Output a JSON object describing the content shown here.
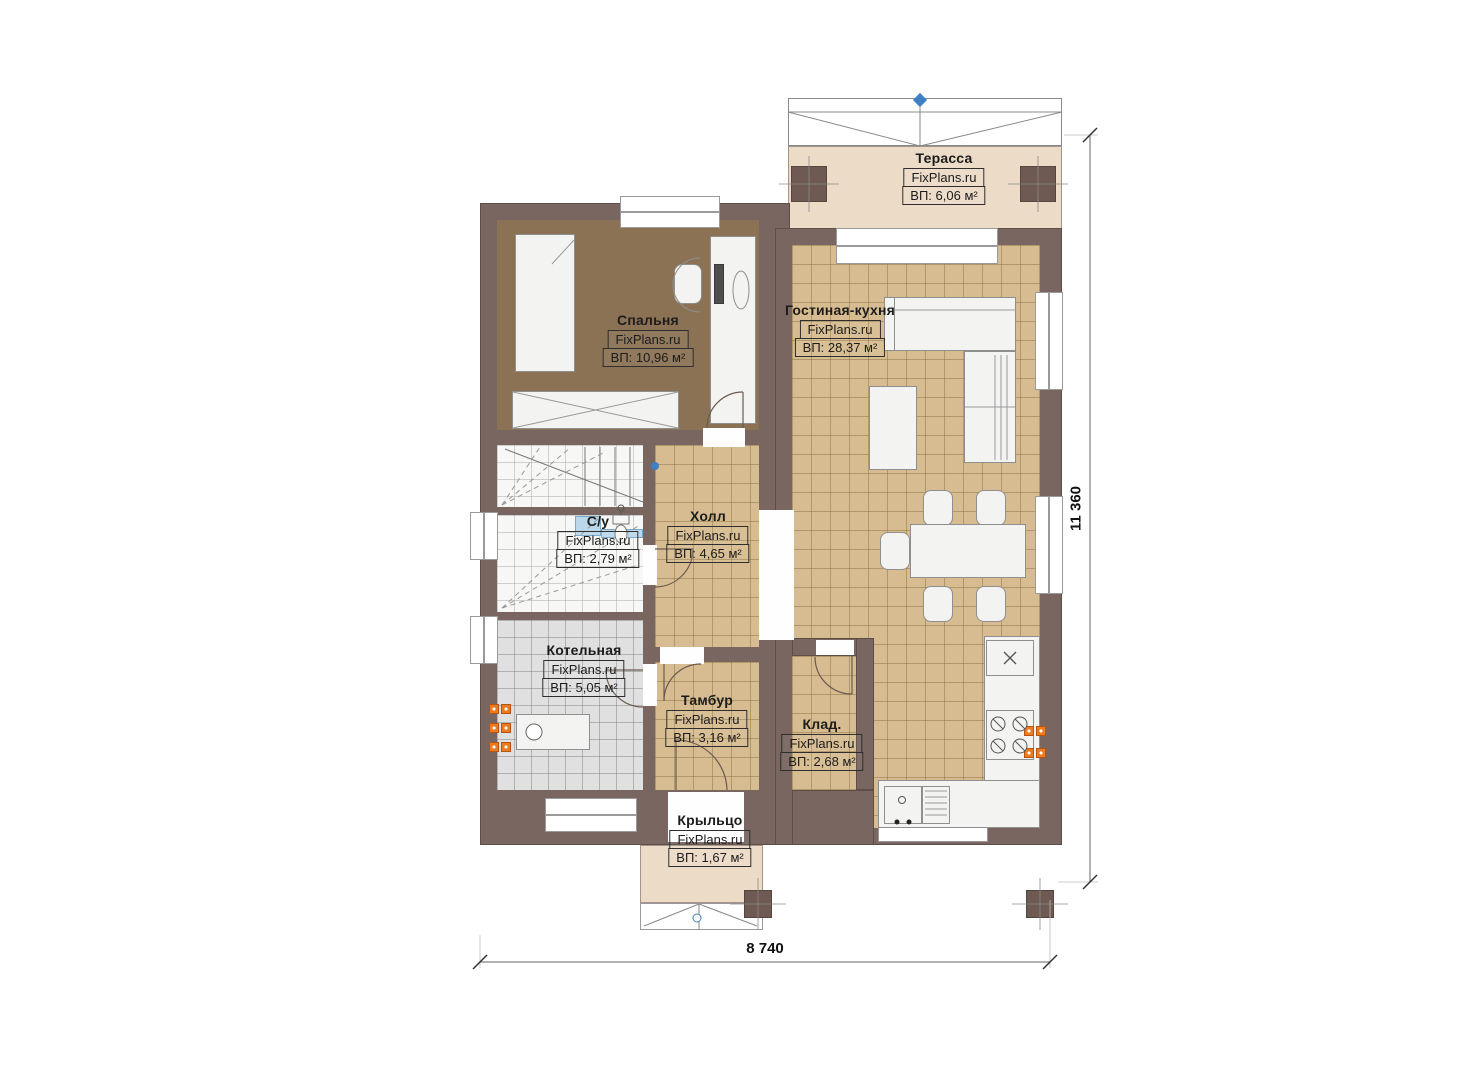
{
  "plan": {
    "brand": "FixPlans.ru",
    "dimensions": {
      "width_label": "8 740",
      "height_label": "11 360"
    },
    "rooms": [
      {
        "id": "terrace",
        "name": "Терасса",
        "area": "ВП: 6,06 м²"
      },
      {
        "id": "bedroom",
        "name": "Спальня",
        "area": "ВП: 10,96 м²"
      },
      {
        "id": "living-kitchen",
        "name": "Гостиная-кухня",
        "area": "ВП: 28,37 м²"
      },
      {
        "id": "bathroom",
        "name": "С/у",
        "area": "ВП: 2,79 м²"
      },
      {
        "id": "hall",
        "name": "Холл",
        "area": "ВП: 4,65 м²"
      },
      {
        "id": "boiler-room",
        "name": "Котельная",
        "area": "ВП: 5,05 м²"
      },
      {
        "id": "vestibule",
        "name": "Тамбур",
        "area": "ВП: 3,16 м²"
      },
      {
        "id": "storage",
        "name": "Клад.",
        "area": "ВП: 2,68 м²"
      },
      {
        "id": "porch",
        "name": "Крыльцо",
        "area": "ВП: 1,67 м²"
      }
    ]
  },
  "colors": {
    "wall": "#796660",
    "floor_tan": "#d6bc90",
    "floor_bedroom": "#8b7254",
    "floor_gray": "#e0e0e0",
    "terrace_beige": "#ecdbc7",
    "accent_orange": "#ed7a1e",
    "marker_blue": "#3f7fc4"
  }
}
